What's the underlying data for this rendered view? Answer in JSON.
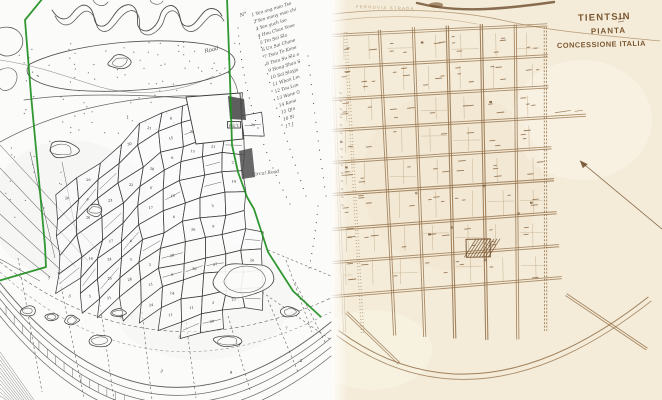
{
  "left_map": {
    "paper_color": "#fbfbfa",
    "ink_color": "#3f3f3f",
    "boundary_color": "#1f8f1f",
    "list_header": "N°",
    "owners": [
      {
        "n": "1",
        "name": "Yen ang mao Tso"
      },
      {
        "n": "2",
        "name": "Yen mony mao chi"
      },
      {
        "n": "3",
        "name": "Yen yuch lao"
      },
      {
        "n": "4",
        "name": "Hou Chan Yone"
      },
      {
        "n": "5",
        "name": "Tin Sai Sla"
      },
      {
        "n": "6",
        "name": "Un Sai Chane"
      },
      {
        "n": "7",
        "name": "Tsau To Kone"
      },
      {
        "n": "8",
        "name": "Tsau Su Sla o"
      },
      {
        "n": "9",
        "name": "Hong Shan S"
      },
      {
        "n": "10",
        "name": "Sal Slayja"
      },
      {
        "n": "11",
        "name": "Wban Lm"
      },
      {
        "n": "12",
        "name": "Tou Lan"
      },
      {
        "n": "13",
        "name": "Wane G"
      },
      {
        "n": "14",
        "name": "Kone"
      },
      {
        "n": "15",
        "name": "Qin"
      },
      {
        "n": "16",
        "name": "Sl"
      },
      {
        "n": "17",
        "name": "J"
      }
    ],
    "labels": {
      "road": "Road",
      "circular_road": "Circul Road",
      "rct": "R.C.T."
    }
  },
  "right_map": {
    "paper_color": "#f4ecd9",
    "ink_color": "#96734c",
    "ink_dark": "#6e4c2a",
    "label_ink": "#8a6743",
    "title_color": "#7c5832",
    "title_lines": [
      "TIENTSIN",
      "PIANTA",
      "CONCESSIONE ITALIA"
    ],
    "railway_label": "FERROVIA STRADA"
  }
}
